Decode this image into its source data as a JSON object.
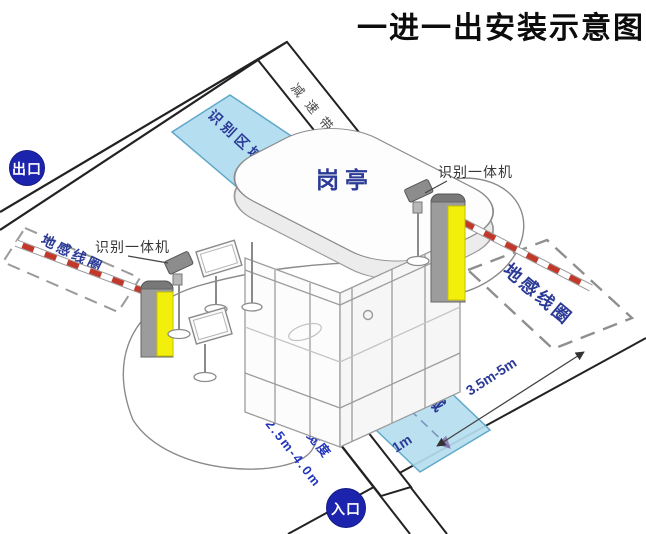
{
  "title": "一进一出安装示意图",
  "badges": {
    "exit": "出口",
    "entrance": "入口"
  },
  "booth": {
    "label": "岗亭"
  },
  "areas": {
    "recognition_top": "识别区域",
    "recognition_bottom": "识别区域",
    "loop_left": "地感线圈",
    "loop_right": "地感线圈"
  },
  "devices": {
    "reader_left": "识别一体机",
    "reader_right": "识别一体机"
  },
  "bands": {
    "speed_bump_top": "减速带",
    "speed_bump_bottom": "减速带"
  },
  "dimensions": {
    "loop_distance": "3.5m-5m",
    "stop_line": "1m",
    "lane_width_label": "车道宽度",
    "lane_width_value": "2.5m-4.0m"
  },
  "colors": {
    "badge_blue": "#1c24ad",
    "zone_blue_fill": "#b5def0",
    "zone_blue_stroke": "#5fa8c8",
    "machine_yellow": "#f2ef0a",
    "machine_gray": "#9c9c9c",
    "arm_red": "#c0392b",
    "label_navy": "#2b3a96",
    "line_black": "#222222"
  }
}
